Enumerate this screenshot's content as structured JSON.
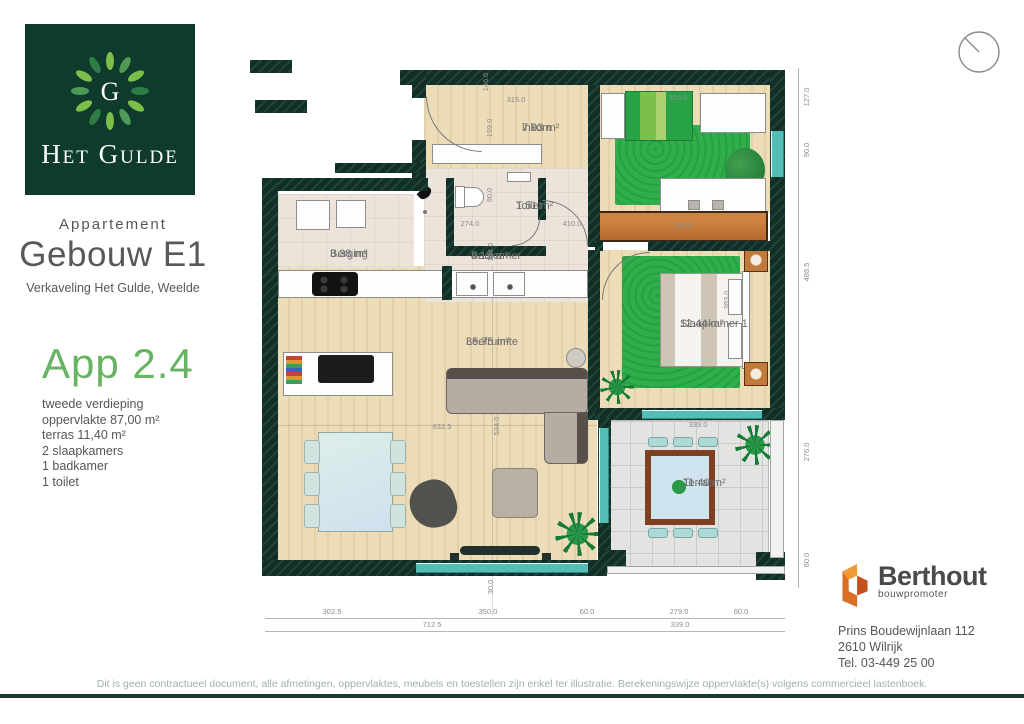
{
  "brand": {
    "logo_title": "Het Gulde",
    "logo_letter": "G",
    "colors": {
      "logo_bg": "#0e3b2b",
      "accent_green": "#66b361",
      "wall": "#14302a",
      "window_teal": "#54bdb6",
      "wardrobe_orange": "#c0722f",
      "rug_green": "#2fae4a",
      "berthout_orange": "#d96f26",
      "footer_line": "#1c3a30"
    }
  },
  "header": {
    "subtitle": "Appartement",
    "title": "Gebouw E1",
    "location": "Verkaveling Het Gulde, Weelde"
  },
  "apartment": {
    "name": "App 2.4",
    "details": [
      "tweede verdieping",
      "oppervlakte 87,00 m²",
      "terras 11,40 m²",
      "2 slaapkamers",
      "1 badkamer",
      "1 toilet"
    ]
  },
  "plan": {
    "rooms": {
      "inkom": {
        "name": "inkom",
        "area": "7.93 m²"
      },
      "toilet": {
        "name": "Toilet",
        "area": "1.51 m²"
      },
      "berging": {
        "name": "Berging",
        "area": "3.38 m²"
      },
      "badkamer": {
        "name": "Badkamer",
        "area": "4.15 m²"
      },
      "leefruimte": {
        "name": "Leefruimte",
        "area": "35.75 m²"
      },
      "slaapkamer1": {
        "name": "Slaapkamer 1",
        "area": "12.44 m²"
      },
      "terras": {
        "name": "Terras",
        "area": "11.40 m²"
      }
    },
    "dimensions": [
      {
        "t": "315.0",
        "x": 266,
        "y": 40
      },
      {
        "t": "146.0",
        "x": 236,
        "y": 22,
        "r": -90
      },
      {
        "t": "159.0",
        "x": 240,
        "y": 68,
        "r": -90
      },
      {
        "t": "325.0",
        "x": 428,
        "y": 38
      },
      {
        "t": "90.0",
        "x": 240,
        "y": 135,
        "r": -90
      },
      {
        "t": "274.0",
        "x": 220,
        "y": 164
      },
      {
        "t": "410.0",
        "x": 322,
        "y": 164
      },
      {
        "t": "154.0",
        "x": 241,
        "y": 192,
        "r": -90
      },
      {
        "t": "325.0",
        "x": 433,
        "y": 166
      },
      {
        "t": "383.0",
        "x": 477,
        "y": 240,
        "r": -90
      },
      {
        "t": "632.5",
        "x": 192,
        "y": 367
      },
      {
        "t": "534.0",
        "x": 247,
        "y": 366,
        "r": -90
      },
      {
        "t": "339.0",
        "x": 448,
        "y": 365
      },
      {
        "t": "30.0",
        "x": 241,
        "y": 527,
        "r": -90
      },
      {
        "t": "127.0",
        "x": 557,
        "y": 37,
        "r": -90
      },
      {
        "t": "90.0",
        "x": 557,
        "y": 90,
        "r": -90
      },
      {
        "t": "488.5",
        "x": 557,
        "y": 212,
        "r": -90
      },
      {
        "t": "276.0",
        "x": 557,
        "y": 392,
        "r": -90
      },
      {
        "t": "60.0",
        "x": 557,
        "y": 500,
        "r": -90
      },
      {
        "t": "302.5",
        "x": 82,
        "y": 552
      },
      {
        "t": "350.0",
        "x": 238,
        "y": 552
      },
      {
        "t": "60.0",
        "x": 337,
        "y": 552
      },
      {
        "t": "279.0",
        "x": 429,
        "y": 552
      },
      {
        "t": "60.0",
        "x": 491,
        "y": 552
      },
      {
        "t": "712.5",
        "x": 182,
        "y": 565
      },
      {
        "t": "339.0",
        "x": 430,
        "y": 565
      }
    ]
  },
  "developer": {
    "name": "Berthout",
    "tagline": "bouwpromoter",
    "address": [
      "Prins Boudewijnlaan 112",
      "2610 Wilrijk",
      "Tel. 03-449 25 00"
    ]
  },
  "footer": {
    "disclaimer": "Dit is geen contractueel document, alle afmetingen, oppervlaktes, meubels en toestellen zijn enkel ter illustratie. Berekeningswijze oppervlakte(s) volgens commercieel lastenboek."
  }
}
